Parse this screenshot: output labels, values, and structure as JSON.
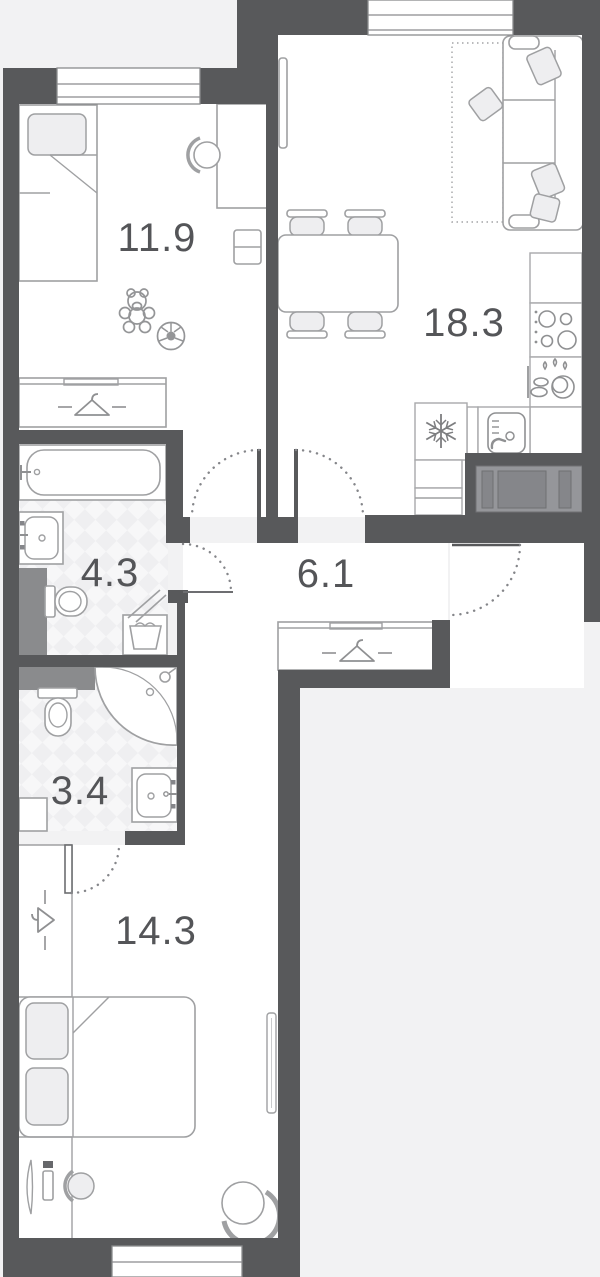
{
  "plan": {
    "type": "apartment-floor-plan",
    "rooms": [
      {
        "id": "kids-bedroom",
        "area_label": "11.9"
      },
      {
        "id": "living-kitchen",
        "area_label": "18.3"
      },
      {
        "id": "bathroom",
        "area_label": "4.3"
      },
      {
        "id": "hallway",
        "area_label": "6.1"
      },
      {
        "id": "shower-room",
        "area_label": "3.4"
      },
      {
        "id": "bedroom",
        "area_label": "14.3"
      }
    ],
    "fixtures": [
      "single-bed",
      "desk",
      "desk-chair",
      "teddy-bear",
      "soccer-ball",
      "wardrobe-hanger",
      "corner-sofa",
      "pillows",
      "rug",
      "tv-panel",
      "dining-table",
      "four-chairs",
      "cooktop",
      "dish-dryer",
      "kitchen-sink",
      "fridge-snowflake",
      "bathtub",
      "wash-basin",
      "toilet",
      "laundry-basket",
      "ventilation-shaft",
      "corner-shower",
      "entrance-door",
      "interior-doors",
      "double-bed",
      "dressing-table",
      "stool",
      "armchair",
      "radiator",
      "windows"
    ],
    "colors": {
      "wall": "#58595b",
      "outside": "#f2f2f3",
      "room": "#ffffff",
      "furniture_line": "#9fa0a2",
      "label_text": "#545558",
      "shaft_gray": "#8a8b8d",
      "tile_light": "#f7f7f8",
      "tile_dark": "#efeff1"
    }
  }
}
